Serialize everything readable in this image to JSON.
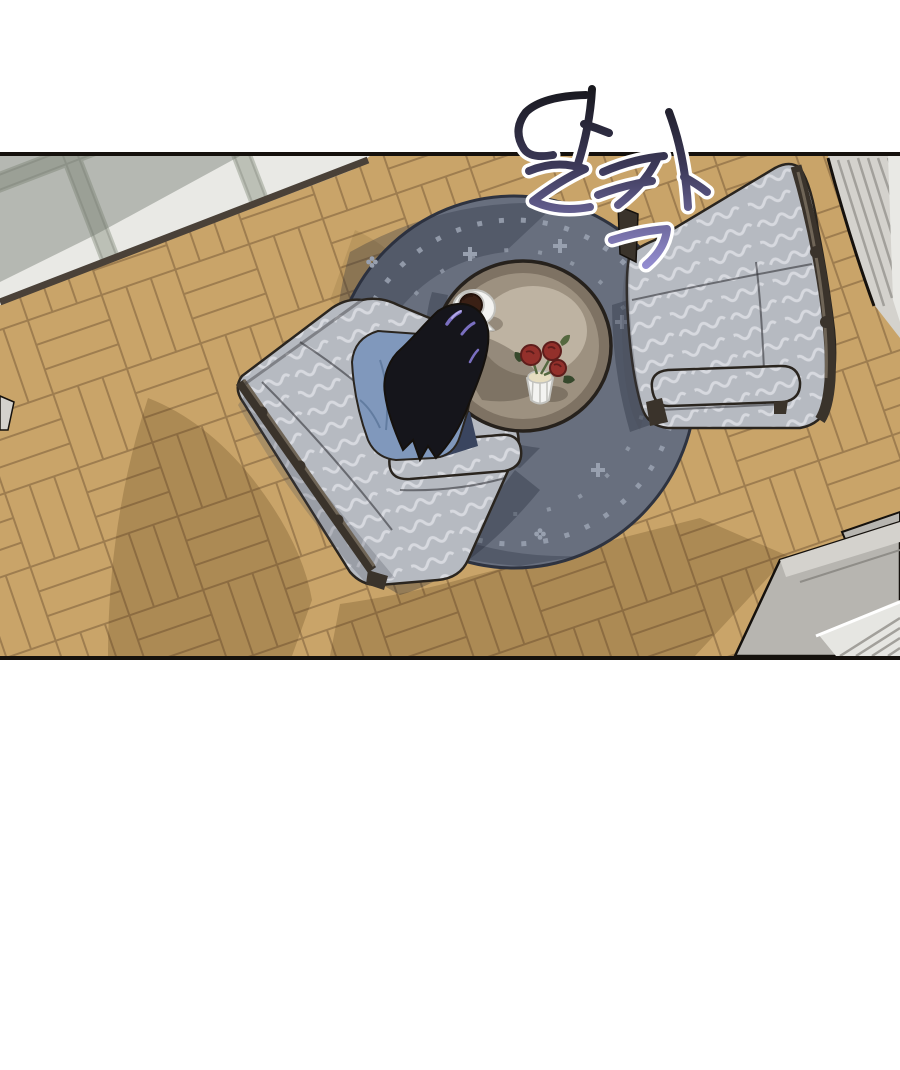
{
  "page": {
    "kind": "webtoon-panel",
    "description": "Top-down view of a living room: woman with long black hair sits in a patterned armchair at a round coffee table on a circular rug; a second armchair faces her; parquet floor, tiled entry top-left, steps bottom-right."
  },
  "sfx": {
    "text": "달칵",
    "romanized": "dalkak",
    "meaning": "click",
    "outline": "#ffffff",
    "gradient_top": "#17171c",
    "gradient_mid": "#3d3a5a",
    "gradient_bottom": "#968fd4"
  },
  "labels": {
    "panel": "living room viewed from above",
    "floor_wood": "parquet wood floor",
    "floor_tile": "tiled entry floor",
    "rug": "round blue-gray rug with dotted border motifs",
    "table": "round wooden coffee table",
    "cup": "coffee cup on saucer",
    "vase": "white vase with red roses",
    "chair_left": "patterned armchair with seated woman",
    "chair_right": "patterned armchair with carved wood trim",
    "person": "woman with long black hair in blue top",
    "steps": "gray steps at bottom right",
    "stairs_top": "striped step area top right",
    "sfx": "sound effect text"
  },
  "colors": {
    "bg": "#ffffff",
    "ink": "#15110d",
    "wood_floor": "#c9a469",
    "wood_line": "#96764a",
    "wood_shadow": "rgba(88,60,24,0.25)",
    "tile_floor": "#e9e9e5",
    "tile_band": "#bcc0b6",
    "tile_band_line": "#a4a89e",
    "tile_shadow": "rgba(110,116,108,0.42)",
    "threshold": "#4a4138",
    "rug_base": "#686f7e",
    "rug_dark": "rgba(40,46,62,0.32)",
    "rug_motif": "#98a0af",
    "rug_edge": "#2e3340",
    "shadow_rug": "rgba(28,33,48,0.30)",
    "table_rim": "#7e7263",
    "table_top": "#9d9180",
    "table_center": "#beb3a2",
    "table_shade": "rgba(62,52,40,0.32)",
    "table_outline": "#26211c",
    "chair_fabric": "#b6bac1",
    "chair_pattern": "#d9dce1",
    "chair_shade": "rgba(70,76,88,0.25)",
    "chair_wood": "#3a332b",
    "chair_wood_hi": "#6f6557",
    "chair_outline": "#2a251f",
    "hair": "#15151b",
    "hair_hi": "#7a6fc0",
    "hair_hi2": "#b3a8e8",
    "shirt": "#8098bc",
    "shirt_fold": "#5f7a9e",
    "pants": "#3a455f",
    "porcelain": "#f3f3f1",
    "porcelain_shade": "#c2c2be",
    "coffee": "#3a2015",
    "coffee_dark": "#23120b",
    "rose": "#93302b",
    "rose_dark": "#5e1d1b",
    "leaf": "#55683f",
    "leaf_dark": "#36482c",
    "vase_top": "#e6ddc0",
    "steps_face": "#b7b5b0",
    "steps_top": "#d4d2cd",
    "steps_line": "#8f8d88",
    "stripe_light": "#e6e6e2",
    "stripe_dark": "#a2a09b"
  }
}
